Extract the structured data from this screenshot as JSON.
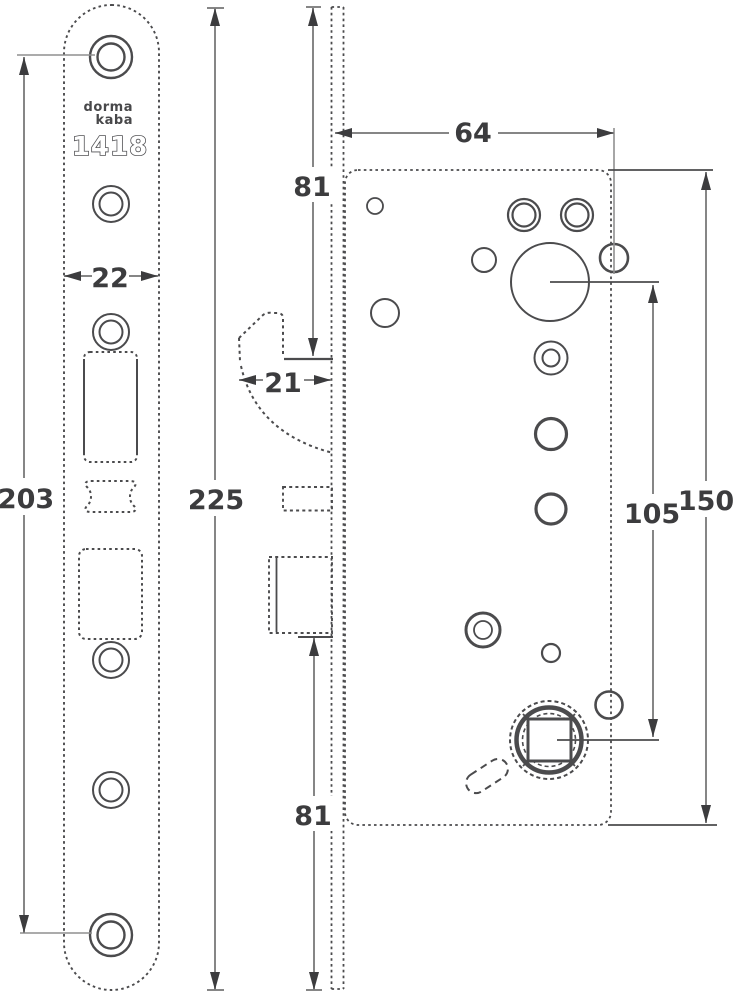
{
  "drawing": {
    "product": {
      "brand_line1": "dorma",
      "brand_line2": "kaba",
      "model": "1418"
    },
    "dimensions": {
      "faceplate_hole_distance": "203",
      "faceplate_width": "22",
      "faceplate_total_length": "225",
      "upper_offset": "81",
      "latch_protrusion": "21",
      "case_depth": "64",
      "cylinder_to_follower_distance": "105",
      "case_height": "150",
      "lower_offset": "81"
    },
    "colors": {
      "dimension_line": "#868686",
      "drawing_line": "#4b4b4d",
      "text": "#3c3c3e",
      "background": "#ffffff"
    }
  }
}
